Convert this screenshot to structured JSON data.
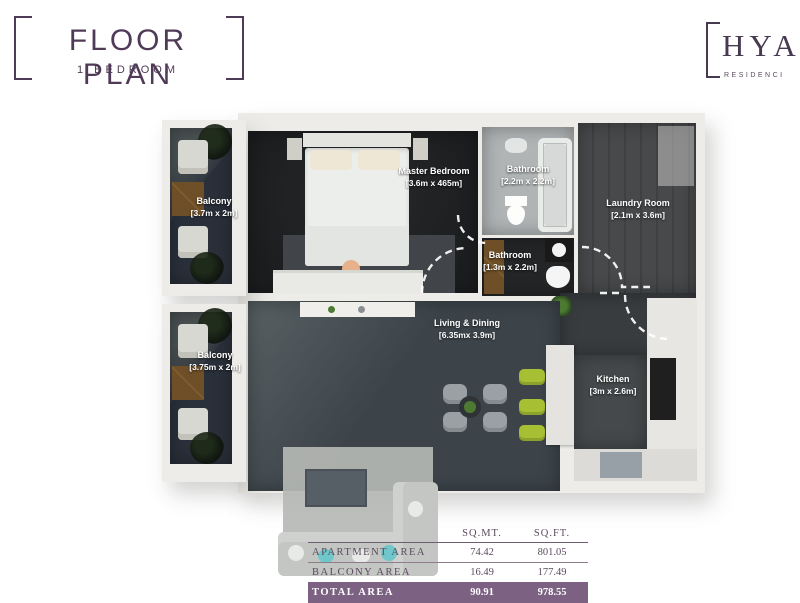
{
  "header": {
    "title": "FLOOR PLAN",
    "subtitle": "1 BEDROOM"
  },
  "logo": {
    "name": "HYA",
    "tagline": "RESIDENCI"
  },
  "rooms": {
    "master": {
      "name": "Master Bedroom",
      "dims": "[3.6m x 465m]"
    },
    "bath1": {
      "name": "Bathroom",
      "dims": "[2.2m x 2.2m]"
    },
    "laundry": {
      "name": "Laundry Room",
      "dims": "[2.1m x 3.6m]"
    },
    "bath2": {
      "name": "Bathroom",
      "dims": "[1.3m x 2.2m]"
    },
    "living": {
      "name": "Living & Dining",
      "dims": "[6.35mx 3.9m]"
    },
    "kitchen": {
      "name": "Kitchen",
      "dims": "[3m x 2.6m]"
    },
    "balcony1": {
      "name": "Balcony",
      "dims": "[3.7m x 2m]"
    },
    "balcony2": {
      "name": "Balcony",
      "dims": "[3.75m x 2m]"
    }
  },
  "area_table": {
    "col_sqmt": "SQ.MT.",
    "col_sqft": "SQ.FT.",
    "rows": [
      {
        "label": "APARTMENT AREA",
        "sqmt": "74.42",
        "sqft": "801.05"
      },
      {
        "label": "BALCONY AREA",
        "sqmt": "16.49",
        "sqft": "177.49"
      },
      {
        "label": "TOTAL AREA",
        "sqmt": "90.91",
        "sqft": "978.55"
      }
    ]
  },
  "colors": {
    "accent_purple": "#4f3b57",
    "total_row_purple": "#7c6183",
    "lime_accent": "#a6bf33",
    "dark_floor": "#1f2123",
    "living_floor": "#3c444a"
  }
}
